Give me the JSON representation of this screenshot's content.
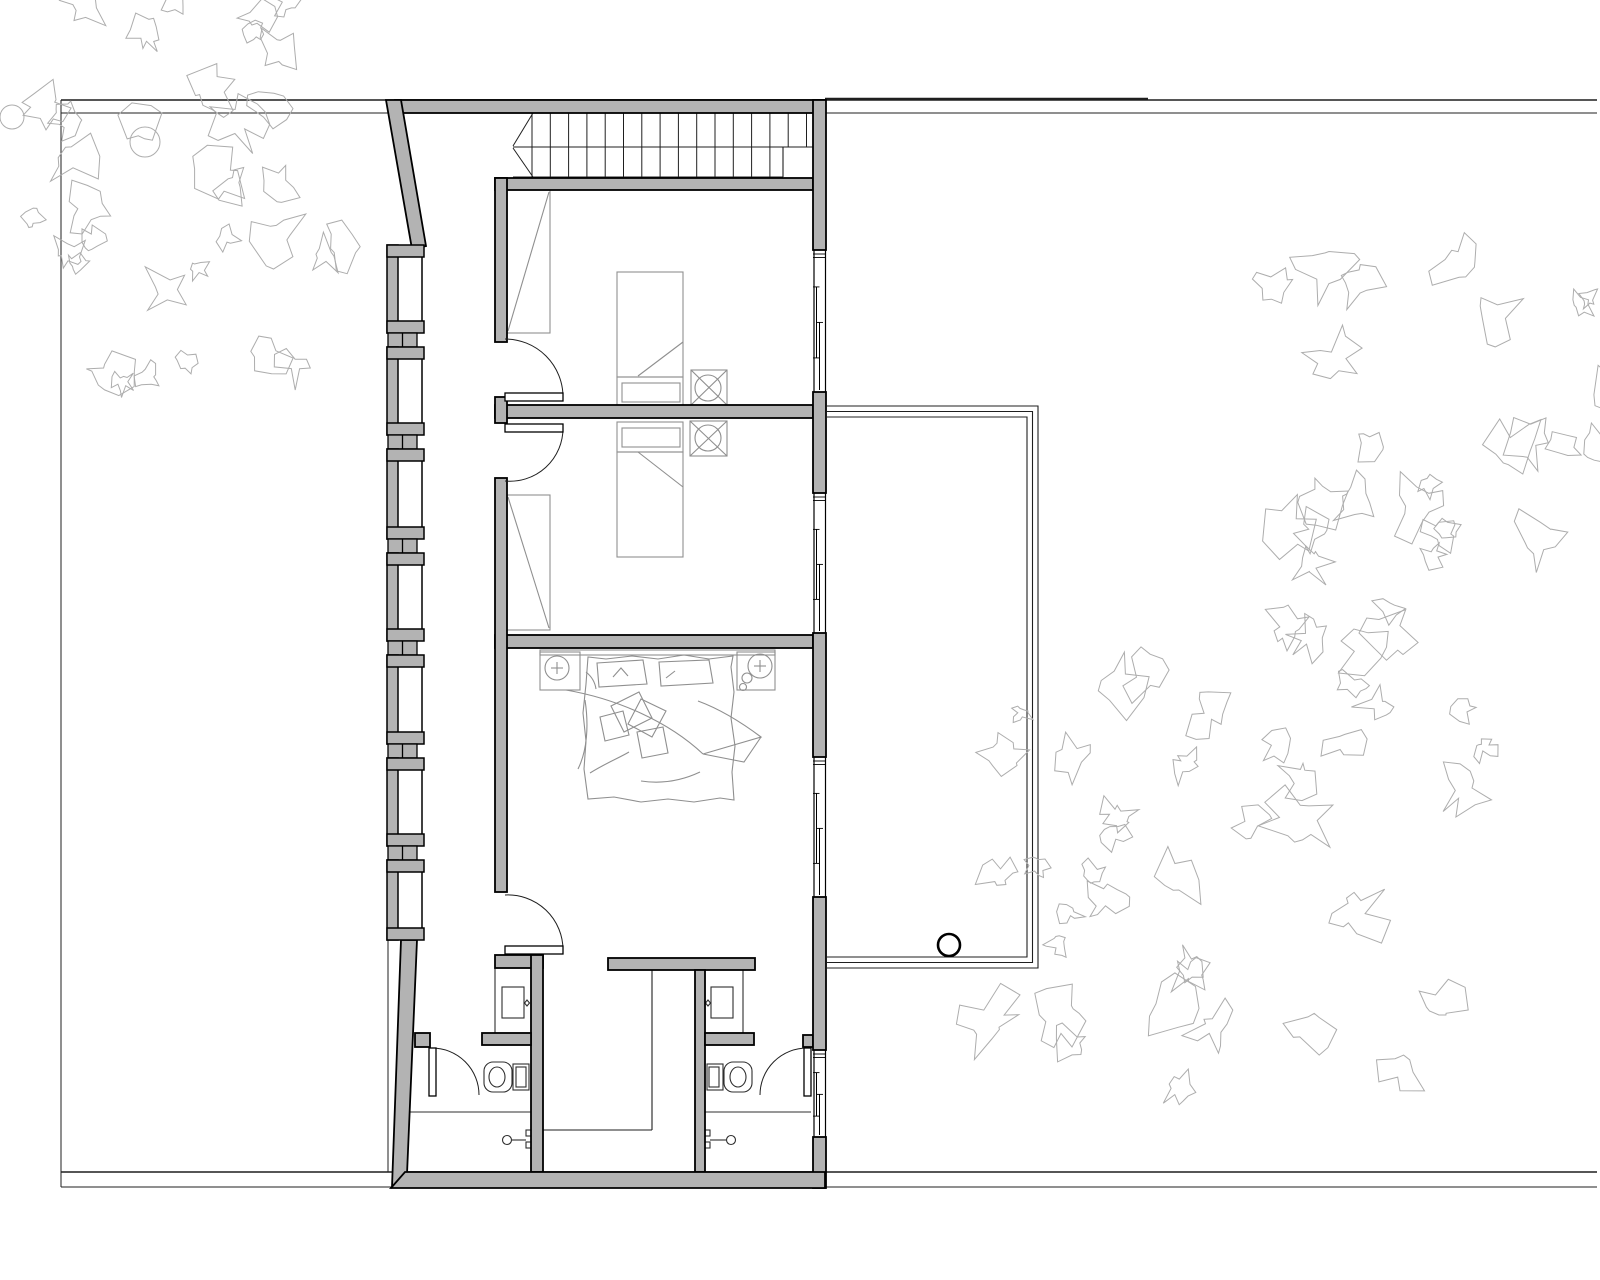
{
  "meta": {
    "drawing_type": "architectural-floor-plan",
    "floor": "bedroom-level"
  },
  "colors": {
    "background": "#ffffff",
    "wall_fill": "#b3b3b3",
    "wall_stroke": "#000000",
    "thin_line": "#1f1f1f",
    "stair_line": "#1f1f1f",
    "furniture": "#8f8f8f",
    "fixture": "#2f2f2f",
    "vegetation": "#adadad"
  },
  "canvas": {
    "w": 1600,
    "h": 1280
  },
  "site": {
    "lines": [
      {
        "name": "site-line-top-outer",
        "x1": 61,
        "y1": 100,
        "x2": 1597,
        "y2": 100,
        "w": 1.4
      },
      {
        "name": "neighbor-wall-top",
        "x1": 825,
        "y1": 99,
        "x2": 1148,
        "y2": 99,
        "w": 2.6
      },
      {
        "name": "site-line-top-inner",
        "x1": 61,
        "y1": 113,
        "x2": 1597,
        "y2": 113,
        "w": 1.0
      },
      {
        "name": "site-line-bottom-inner",
        "x1": 61,
        "y1": 1172,
        "x2": 1597,
        "y2": 1172,
        "w": 1.4
      },
      {
        "name": "site-line-bottom-outer",
        "x1": 61,
        "y1": 1187,
        "x2": 1597,
        "y2": 1187,
        "w": 1.0
      },
      {
        "name": "site-line-left",
        "x1": 61,
        "y1": 100,
        "x2": 61,
        "y2": 1187,
        "w": 1.0
      },
      {
        "name": "site-line-below-house",
        "x1": 388,
        "y1": 940,
        "x2": 388,
        "y2": 1172,
        "w": 1.0
      }
    ]
  },
  "balcony": {
    "x1": 827,
    "y1": 406,
    "x2": 1038,
    "y2": 968,
    "insets": [
      0,
      5.5,
      11
    ],
    "circle": {
      "cx": 949,
      "cy": 945,
      "r": 11,
      "w": 2.6
    }
  },
  "stairs": {
    "yTop": 113,
    "yMid": 147,
    "yBot": 177,
    "xLeft": 513,
    "xRight": 813,
    "xLowEnd": 783,
    "treadStart": 532,
    "treadStep": 18.3,
    "treadsUpper": 16,
    "treadsLower": 14,
    "breaks": [
      [
        533,
        113,
        513,
        146
      ],
      [
        513,
        148,
        533,
        177
      ]
    ]
  },
  "walls": {
    "rects": [
      {
        "name": "top-wall",
        "x": 395,
        "y": 100,
        "w": 430,
        "h": 13
      },
      {
        "name": "bedroom1-top-wall",
        "x": 495,
        "y": 178,
        "w": 318,
        "h": 12
      },
      {
        "name": "divider-bed1-bed2",
        "x": 495,
        "y": 405,
        "w": 318,
        "h": 13
      },
      {
        "name": "divider-bed2-master",
        "x": 495,
        "y": 635,
        "w": 318,
        "h": 13
      },
      {
        "name": "corridor-wall-a",
        "x": 495,
        "y": 178,
        "w": 12,
        "h": 164
      },
      {
        "name": "corridor-wall-b",
        "x": 495,
        "y": 397,
        "w": 12,
        "h": 26
      },
      {
        "name": "corridor-wall-c",
        "x": 495,
        "y": 478,
        "w": 12,
        "h": 414
      },
      {
        "name": "bath-left-top-wall",
        "x": 495,
        "y": 955,
        "w": 48,
        "h": 13
      },
      {
        "name": "bath-left-right-wall",
        "x": 531,
        "y": 955,
        "w": 12,
        "h": 217
      },
      {
        "name": "hall-top-bar",
        "x": 608,
        "y": 958,
        "w": 147,
        "h": 12
      },
      {
        "name": "bath-right-left-wall",
        "x": 695,
        "y": 970,
        "w": 10,
        "h": 202
      },
      {
        "name": "stub-left-mid",
        "x": 482,
        "y": 1033,
        "w": 49,
        "h": 12
      },
      {
        "name": "stub-left-hinge",
        "x": 415,
        "y": 1033,
        "w": 15,
        "h": 14
      },
      {
        "name": "stub-right-mid",
        "x": 705,
        "y": 1033,
        "w": 49,
        "h": 12
      },
      {
        "name": "stub-right-hinge",
        "x": 803,
        "y": 1035,
        "w": 10,
        "h": 12
      },
      {
        "name": "right-wall-a",
        "x": 813,
        "y": 100,
        "w": 13,
        "h": 150
      },
      {
        "name": "right-wall-b",
        "x": 813,
        "y": 392,
        "w": 13,
        "h": 101
      },
      {
        "name": "right-wall-c",
        "x": 813,
        "y": 633,
        "w": 13,
        "h": 124
      },
      {
        "name": "right-wall-d",
        "x": 813,
        "y": 897,
        "w": 13,
        "h": 153
      },
      {
        "name": "right-wall-e",
        "x": 813,
        "y": 1137,
        "w": 13,
        "h": 51
      }
    ],
    "polys": [
      {
        "name": "slanted-wall-top-left",
        "pts": "386,100 401,100 426,246 412,249"
      },
      {
        "name": "slanted-wall-bottom-left",
        "pts": "401,940 417,940 407,1174 392,1187"
      },
      {
        "name": "bottom-wall",
        "pts": "405,1172 825,1172 825,1188 391,1188"
      }
    ]
  },
  "pillars": {
    "x": 387,
    "stripW": 11,
    "flangeLen": 37,
    "flangeT": 12,
    "closeX": 422,
    "glazeX": 388,
    "glazeW": 29,
    "mullionX": 402.5,
    "sections": [
      [
        245,
        333
      ],
      [
        347,
        435
      ],
      [
        449,
        539
      ],
      [
        553,
        641
      ],
      [
        655,
        744
      ],
      [
        758,
        846
      ],
      [
        860,
        940
      ]
    ]
  },
  "windows": {
    "x1": 813,
    "x2": 826,
    "items": [
      {
        "name": "window-bedroom1",
        "y1": 250,
        "y2": 392
      },
      {
        "name": "window-bedroom2",
        "y1": 493,
        "y2": 633
      },
      {
        "name": "window-master-bedroom",
        "y1": 757,
        "y2": 897
      },
      {
        "name": "window-bath-right",
        "y1": 1050,
        "y2": 1137
      }
    ]
  },
  "doors": [
    {
      "name": "door-bedroom1",
      "leaf": [
        505,
        393,
        58,
        8
      ],
      "arc": "M563,397 A58,58 0 0 0 505,339"
    },
    {
      "name": "door-bedroom2",
      "leaf": [
        505,
        424,
        58,
        8
      ],
      "arc": "M563,428 A53,53 0 0 1 505,481"
    },
    {
      "name": "door-master-bedroom",
      "leaf": [
        505,
        946,
        58,
        8
      ],
      "arc": "M563,950 A55,55 0 0 0 505,895"
    },
    {
      "name": "door-bath-left",
      "leaf": [
        429,
        1048,
        7,
        48
      ],
      "arc": "M432,1048 A47,47 0 0 1 479,1095"
    },
    {
      "name": "door-bath-right",
      "leaf": [
        804,
        1048,
        7,
        48
      ],
      "arc": "M807,1048 A47,47 0 0 0 760,1095"
    }
  ],
  "hall_lines": [
    {
      "name": "stair-void-edge-v",
      "x1": 652,
      "y1": 970,
      "x2": 652,
      "y2": 1130
    },
    {
      "name": "stair-void-edge-h",
      "x1": 543,
      "y1": 1130,
      "x2": 652,
      "y2": 1130
    }
  ],
  "furniture": [
    {
      "t": "rect",
      "name": "bed1-mattress",
      "x": 617,
      "y": 272,
      "w": 66,
      "h": 105
    },
    {
      "t": "rect",
      "name": "bed1-foot",
      "x": 617,
      "y": 377,
      "w": 66,
      "h": 30
    },
    {
      "t": "rect",
      "name": "bed1-foot-inner",
      "x": 622,
      "y": 383,
      "w": 58,
      "h": 19
    },
    {
      "t": "line",
      "name": "bed1-blanket-fold",
      "x1": 683,
      "y1": 342,
      "x2": 638,
      "y2": 376
    },
    {
      "t": "rect",
      "name": "bed2-mattress",
      "x": 617,
      "y": 452,
      "w": 66,
      "h": 105
    },
    {
      "t": "rect",
      "name": "bed2-foot",
      "x": 617,
      "y": 422,
      "w": 66,
      "h": 30
    },
    {
      "t": "rect",
      "name": "bed2-foot-inner",
      "x": 622,
      "y": 428,
      "w": 58,
      "h": 19
    },
    {
      "t": "line",
      "name": "bed2-blanket-fold",
      "x1": 638,
      "y1": 452,
      "x2": 683,
      "y2": 487
    },
    {
      "t": "rect",
      "name": "chair1-symbol",
      "x": 691,
      "y": 370,
      "w": 36,
      "h": 35
    },
    {
      "t": "circle",
      "name": "chair1-seat",
      "cx": 708,
      "cy": 388,
      "r": 13
    },
    {
      "t": "line",
      "name": "chair1-cross-a",
      "x1": 691,
      "y1": 370,
      "x2": 727,
      "y2": 405
    },
    {
      "t": "line",
      "name": "chair1-cross-b",
      "x1": 727,
      "y1": 370,
      "x2": 691,
      "y2": 405
    },
    {
      "t": "rect",
      "name": "chair2-symbol",
      "x": 690,
      "y": 421,
      "w": 37,
      "h": 35
    },
    {
      "t": "circle",
      "name": "chair2-seat",
      "cx": 708,
      "cy": 438,
      "r": 13
    },
    {
      "t": "line",
      "name": "chair2-cross-a",
      "x1": 690,
      "y1": 421,
      "x2": 727,
      "y2": 456
    },
    {
      "t": "line",
      "name": "chair2-cross-b",
      "x1": 727,
      "y1": 421,
      "x2": 690,
      "y2": 456
    },
    {
      "t": "rect",
      "name": "wardrobe1",
      "x": 507,
      "y": 190,
      "w": 43,
      "h": 143
    },
    {
      "t": "line",
      "name": "wardrobe1-door",
      "x1": 549,
      "y1": 192,
      "x2": 508,
      "y2": 331
    },
    {
      "t": "rect",
      "name": "wardrobe2",
      "x": 507,
      "y": 495,
      "w": 43,
      "h": 135
    },
    {
      "t": "line",
      "name": "wardrobe2-door",
      "x1": 508,
      "y1": 497,
      "x2": 549,
      "y2": 628
    },
    {
      "t": "rect",
      "name": "headboard-shelf",
      "x": 540,
      "y": 650,
      "w": 235,
      "h": 5
    },
    {
      "t": "rect",
      "name": "nightstand-left",
      "x": 540,
      "y": 652,
      "w": 40,
      "h": 38
    },
    {
      "t": "circle",
      "name": "lamp-left",
      "cx": 557,
      "cy": 668,
      "r": 12
    },
    {
      "t": "line",
      "name": "lamp-left-cross-h",
      "x1": 551,
      "y1": 668,
      "x2": 563,
      "y2": 668
    },
    {
      "t": "line",
      "name": "lamp-left-cross-v",
      "x1": 557,
      "y1": 662,
      "x2": 557,
      "y2": 674
    },
    {
      "t": "rect",
      "name": "nightstand-right",
      "x": 737,
      "y": 652,
      "w": 38,
      "h": 38
    },
    {
      "t": "circle",
      "name": "lamp-right",
      "cx": 760,
      "cy": 666,
      "r": 12
    },
    {
      "t": "line",
      "name": "lamp-right-cross-h",
      "x1": 754,
      "y1": 666,
      "x2": 766,
      "y2": 666
    },
    {
      "t": "line",
      "name": "lamp-right-cross-v",
      "x1": 760,
      "y1": 660,
      "x2": 760,
      "y2": 672
    },
    {
      "t": "circle",
      "name": "nightstand-right-deco1",
      "cx": 747,
      "cy": 678,
      "r": 5
    },
    {
      "t": "circle",
      "name": "nightstand-right-deco2",
      "cx": 743,
      "cy": 687,
      "r": 3.5
    },
    {
      "t": "path",
      "name": "master-bed-outline",
      "d": "M588,657 L586,684 L583,713 L586,741 L584,769 L588,799 L614,797 L641,802 L668,799 L694,802 L720,798 L734,800 L732,772 L735,746 L731,718 L734,692 L731,667 L733,656 L709,659 L684,655 L658,659 L632,656 L606,659 Z"
    },
    {
      "t": "path",
      "name": "master-bed-pillow1",
      "d": "M597,663 L643,660 L647,684 L599,687 Z"
    },
    {
      "t": "path",
      "name": "master-bed-pillow1-mark",
      "d": "M613,677 L621,668 L628,676"
    },
    {
      "t": "path",
      "name": "master-bed-pillow2",
      "d": "M659,662 L709,660 L713,683 L661,686 Z"
    },
    {
      "t": "path",
      "name": "master-bed-pillow2-mark",
      "d": "M666,678 L675,671"
    },
    {
      "t": "path",
      "name": "master-bed-duvet-fold1",
      "d": "M566,690 C618,699 669,722 703,754"
    },
    {
      "t": "path",
      "name": "master-bed-duvet-fold2",
      "d": "M703,754 L761,737 C737,719 717,708 698,701"
    },
    {
      "t": "path",
      "name": "master-bed-duvet-fold3",
      "d": "M761,737 L744,762 L703,754"
    },
    {
      "t": "path",
      "name": "master-bed-cushion1",
      "d": "M611,706 L639,692 L652,718 L624,732 Z"
    },
    {
      "t": "path",
      "name": "master-bed-cushion2",
      "d": "M641,699 L666,711 L652,737 L628,724 Z"
    },
    {
      "t": "path",
      "name": "master-bed-cushion3",
      "d": "M637,732 L663,727 L668,753 L642,758 Z"
    },
    {
      "t": "path",
      "name": "master-bed-cushion4",
      "d": "M600,717 L623,711 L629,735 L605,741 Z"
    },
    {
      "t": "path",
      "name": "master-bed-wrinkle1",
      "d": "M585,700 C589,726 587,751 578,769"
    },
    {
      "t": "path",
      "name": "master-bed-wrinkle2",
      "d": "M590,773 C606,763 619,758 629,752"
    },
    {
      "t": "path",
      "name": "master-bed-wrinkle3",
      "d": "M700,772 C681,781 661,784 641,781"
    },
    {
      "t": "path",
      "name": "master-bed-wrinkle4",
      "d": "M586,672 C591,676 595,682 596,689"
    }
  ],
  "fixtures": [
    {
      "t": "rect",
      "name": "vanity-left-counter",
      "x": 495,
      "y": 968,
      "w": 36,
      "h": 65
    },
    {
      "t": "rect",
      "name": "vanity-left-sink",
      "x": 502,
      "y": 987,
      "w": 22,
      "h": 31
    },
    {
      "t": "path",
      "name": "vanity-left-knob",
      "d": "M527,1000 L529.5,1003 L527,1006 L524.5,1003 Z"
    },
    {
      "t": "rect",
      "name": "vanity-right-counter",
      "x": 705,
      "y": 968,
      "w": 38,
      "h": 65
    },
    {
      "t": "rect",
      "name": "vanity-right-sink",
      "x": 711,
      "y": 987,
      "w": 22,
      "h": 31
    },
    {
      "t": "path",
      "name": "vanity-right-knob",
      "d": "M708,1000 L710.5,1003 L708,1006 L705.5,1003 Z"
    },
    {
      "t": "rrect",
      "name": "toilet-left-bowl",
      "x": 484,
      "y": 1062,
      "w": 28,
      "h": 30,
      "r": 9
    },
    {
      "t": "ellipse",
      "name": "toilet-left-seat",
      "cx": 497,
      "cy": 1077,
      "rx": 8,
      "ry": 10
    },
    {
      "t": "rect",
      "name": "toilet-left-tank",
      "x": 513,
      "y": 1064,
      "w": 16,
      "h": 26
    },
    {
      "t": "rect",
      "name": "toilet-left-tank-inner",
      "x": 516,
      "y": 1067,
      "w": 10,
      "h": 20
    },
    {
      "t": "rect",
      "name": "toilet-right-tank",
      "x": 707,
      "y": 1064,
      "w": 16,
      "h": 26
    },
    {
      "t": "rect",
      "name": "toilet-right-tank-inner",
      "x": 709,
      "y": 1067,
      "w": 10,
      "h": 20
    },
    {
      "t": "rrect",
      "name": "toilet-right-bowl",
      "x": 724,
      "y": 1062,
      "w": 28,
      "h": 30,
      "r": 9
    },
    {
      "t": "ellipse",
      "name": "toilet-right-seat",
      "cx": 738,
      "cy": 1077,
      "rx": 8,
      "ry": 10
    },
    {
      "t": "line",
      "name": "shower-left-screen",
      "x1": 399,
      "y1": 1112,
      "x2": 531,
      "y2": 1112
    },
    {
      "t": "circle",
      "name": "shower-left-drain",
      "cx": 507,
      "cy": 1140,
      "r": 4.5
    },
    {
      "t": "line",
      "name": "shower-left-arm",
      "x1": 512,
      "y1": 1140,
      "x2": 526,
      "y2": 1140
    },
    {
      "t": "rect",
      "name": "shower-left-valve1",
      "x": 526,
      "y": 1130,
      "w": 6,
      "h": 6
    },
    {
      "t": "rect",
      "name": "shower-left-valve2",
      "x": 526,
      "y": 1142,
      "w": 6,
      "h": 6
    },
    {
      "t": "line",
      "name": "shower-right-screen",
      "x1": 705,
      "y1": 1112,
      "x2": 811,
      "y2": 1112
    },
    {
      "t": "circle",
      "name": "shower-right-drain",
      "cx": 731,
      "cy": 1140,
      "r": 4.5
    },
    {
      "t": "line",
      "name": "shower-right-arm",
      "x1": 710,
      "y1": 1140,
      "x2": 726,
      "y2": 1140
    },
    {
      "t": "rect",
      "name": "shower-right-valve1",
      "x": 704,
      "y": 1130,
      "w": 6,
      "h": 6
    },
    {
      "t": "rect",
      "name": "shower-right-valve2",
      "x": 704,
      "y": 1142,
      "w": 6,
      "h": 6
    }
  ],
  "trees": {
    "clusters": [
      {
        "name": "tree-cluster-top-left-a",
        "cx": 150,
        "cy": 110,
        "rx": 200,
        "ry": 135,
        "n": 24,
        "rmin": 16,
        "rmax": 40,
        "seed": 7
      },
      {
        "name": "tree-cluster-top-left-b",
        "cx": 200,
        "cy": 295,
        "rx": 150,
        "ry": 120,
        "n": 13,
        "rmin": 14,
        "rmax": 34,
        "seed": 19
      },
      {
        "name": "tree-cluster-right-upper",
        "cx": 1450,
        "cy": 455,
        "rx": 190,
        "ry": 205,
        "n": 28,
        "rmin": 16,
        "rmax": 42,
        "seed": 101
      },
      {
        "name": "tree-cluster-right-lower",
        "cx": 1240,
        "cy": 845,
        "rx": 265,
        "ry": 245,
        "n": 40,
        "rmin": 16,
        "rmax": 42,
        "seed": 55
      }
    ],
    "trunks": [
      {
        "name": "tree-trunk-1",
        "cx": 145,
        "cy": 142,
        "r": 15
      },
      {
        "name": "tree-trunk-2",
        "cx": 12,
        "cy": 117,
        "r": 12
      }
    ]
  }
}
